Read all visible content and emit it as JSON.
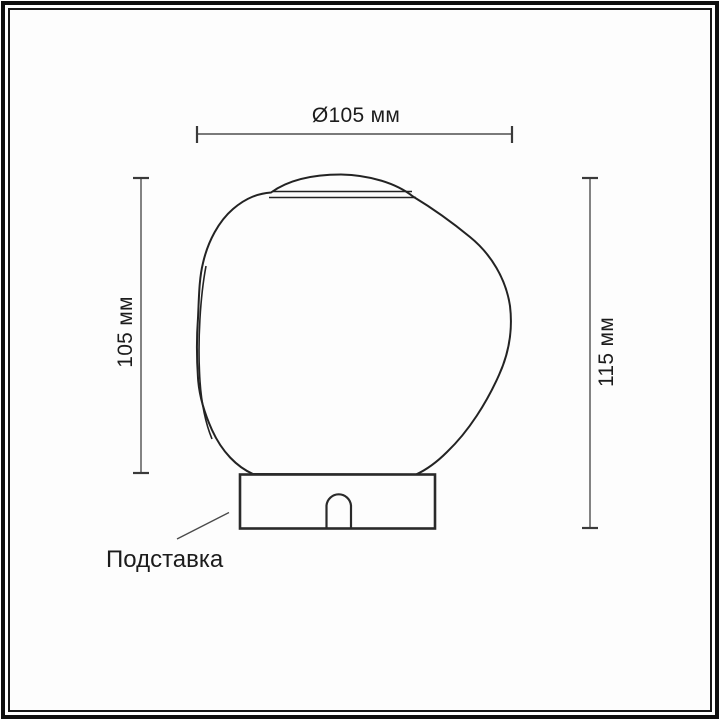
{
  "figure": {
    "type": "technical-dimension-diagram",
    "dimensions": {
      "diameter": {
        "label": "Ø105 мм"
      },
      "glass_height": {
        "label": "105 мм"
      },
      "total_height": {
        "label": "115 мм"
      }
    },
    "callouts": {
      "base": {
        "label": "Подставка"
      }
    },
    "colors": {
      "background": "#fdfdfd",
      "frame": "#0d0d0d",
      "drawing_line": "#232323",
      "dimension_line": "#4a4a4a",
      "text": "#1c1c1c"
    }
  }
}
